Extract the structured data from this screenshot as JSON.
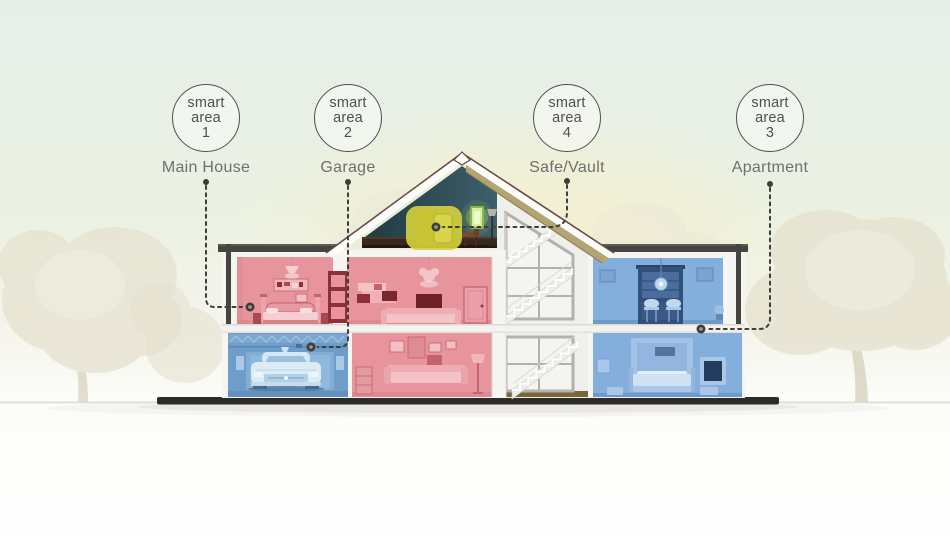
{
  "areas": [
    {
      "badge": {
        "line1": "smart",
        "line2": "area",
        "number": "1"
      },
      "label": "Main House"
    },
    {
      "badge": {
        "line1": "smart",
        "line2": "area",
        "number": "2"
      },
      "label": "Garage"
    },
    {
      "badge": {
        "line1": "smart",
        "line2": "area",
        "number": "4"
      },
      "label": "Safe/Vault"
    },
    {
      "badge": {
        "line1": "smart",
        "line2": "area",
        "number": "3"
      },
      "label": "Apartment"
    }
  ],
  "colors": {
    "zone_pink": "#e8949d",
    "zone_blue": "#84aedb",
    "garage_blue": "#6f9dca",
    "safe_highlight_yellow": "#d6d13e",
    "connector_gray": "#3d3d3d",
    "badge_text": "#4f4f4f",
    "label_text": "#6f6f6f",
    "sky_tint": "#e5efe9",
    "glow_yellow": "#f5efcd",
    "tree_beige": "#e6e2d0",
    "ground_dark": "#2e2c28"
  }
}
